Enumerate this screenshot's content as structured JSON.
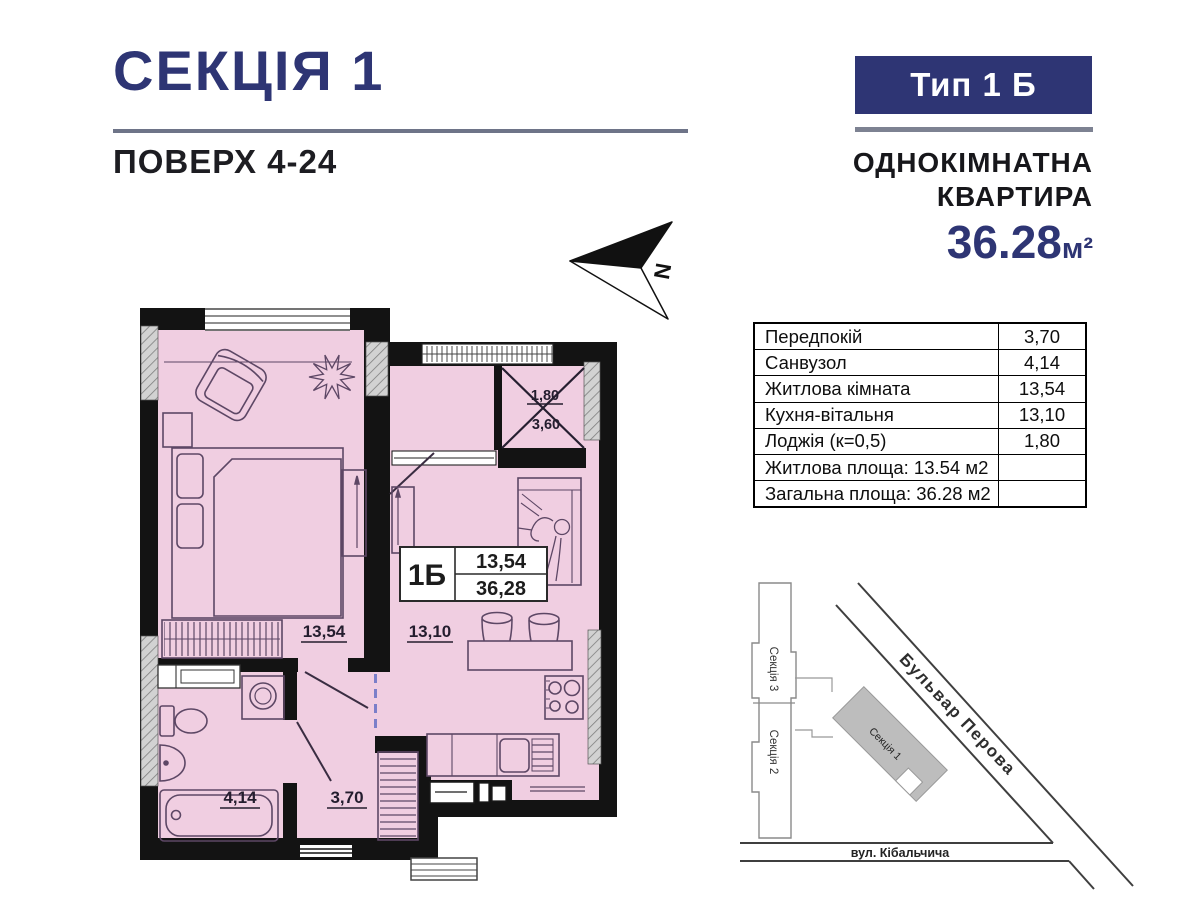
{
  "header": {
    "section_title": "СЕКЦІЯ 1",
    "floors": "ПОВЕРХ 4-24",
    "type_badge": "Тип 1 Б",
    "apartment_kind_line1": "ОДНОКІМНАТНА",
    "apartment_kind_line2": "КВАРТИРА",
    "total_area_value": "36.28",
    "total_area_unit": "м²",
    "accent_color": "#2e3574"
  },
  "compass": {
    "north_label": "N"
  },
  "areas_table": {
    "rows": [
      {
        "label": "Передпокій",
        "value": "3,70"
      },
      {
        "label": "Санвузол",
        "value": "4,14"
      },
      {
        "label": "Житлова кімната",
        "value": "13,54"
      },
      {
        "label": "Кухня-вітальня",
        "value": "13,10"
      },
      {
        "label": "Лоджія (к=0,5)",
        "value": "1,80"
      },
      {
        "label": "Житлова площа: 13.54 м2",
        "value": ""
      },
      {
        "label": "Загальна площа: 36.28 м2",
        "value": ""
      }
    ]
  },
  "floor_plan": {
    "fill_color": "#f0cee1",
    "unit_box": {
      "type": "1Б",
      "living_area": "13,54",
      "total_area": "36,28"
    },
    "room_labels": {
      "living": "13,54",
      "kitchen": "13,10",
      "bathroom": "4,14",
      "hall": "3,70",
      "loggia_width": "1,80",
      "loggia_length": "3,60"
    }
  },
  "site_plan": {
    "buildings": {
      "section3": "Секція 3",
      "section2": "Секція 2",
      "section1": "Секція 1"
    },
    "streets": {
      "boulevard": "Бульвар Перова",
      "street": "вул. Кібальчича"
    }
  }
}
